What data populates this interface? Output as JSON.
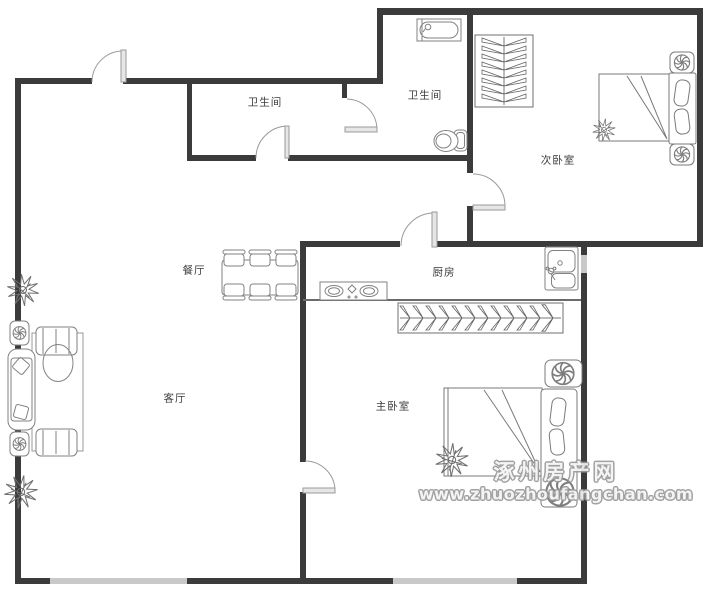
{
  "page": {
    "width": 709,
    "height": 600,
    "background": "#ffffff",
    "type": "apartment-floor-plan"
  },
  "rooms": [
    {
      "id": "bathroom-1",
      "label": "卫生间"
    },
    {
      "id": "bathroom-2",
      "label": "卫生间"
    },
    {
      "id": "secondary-bedroom",
      "label": "次卧室"
    },
    {
      "id": "dining-room",
      "label": "餐厅"
    },
    {
      "id": "kitchen",
      "label": "厨房"
    },
    {
      "id": "living-room",
      "label": "客厅"
    },
    {
      "id": "master-bedroom",
      "label": "主卧室"
    }
  ],
  "watermark": {
    "site_name": "涿州房产网",
    "site_url": "www.zhuozhoufangchan.com"
  },
  "colors": {
    "wall": "#3b3b3b",
    "window_fill": "#c9c9c9",
    "furniture_line": "#828282",
    "door_arc": "#9a9a9a",
    "door_leaf_fill": "#e6e6e6",
    "label_text": "#3a3a3a",
    "watermark_outline": "#9a9a9a",
    "background": "#ffffff"
  },
  "icons": {
    "fan": "ceiling-fan-icon (circle with curved blades)",
    "plant": "plant-icon (spiky star with center dot)",
    "bathtub": "bathtub-icon",
    "toilet": "toilet-icon",
    "sink": "kitchen-sink-icon",
    "stove": "stove-icon (two burners)",
    "wardrobe": "wardrobe-hanger-rail-icon",
    "bed": "double-bed-icon",
    "sofa": "sofa-set-icon",
    "dining_table": "dining-table-six-chairs-icon",
    "door": "door-swing-arc-icon",
    "window": "window-band-icon"
  }
}
